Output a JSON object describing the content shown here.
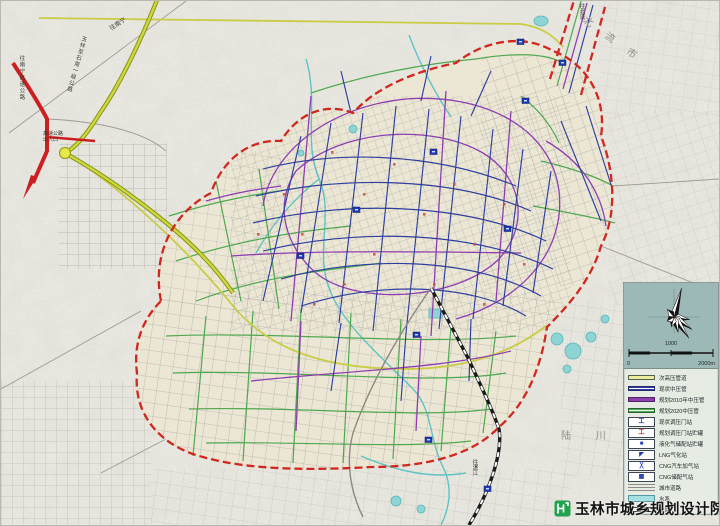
{
  "credit": {
    "institute": "玉林市城乡规划设计院"
  },
  "scale": {
    "zero": "0",
    "mid": "1000",
    "max": "2000m"
  },
  "colors": {
    "boundary_red": "#d02820",
    "pipe_existing_blue": "#2e3f9e",
    "pipe_plan2010_purple": "#8d3fb0",
    "pipe_plan2020_green": "#4fa84f",
    "pipe_subhigh_yellow": "#c9cc44",
    "highway_olive": "#c3cc36",
    "expressway_red": "#cc2020",
    "water_teal": "#5fc3c3",
    "legend_panel_teal": "#9db9b7",
    "credit_green": "#21a24e"
  },
  "legend": {
    "rows": [
      {
        "symbol": "line-yellow",
        "label": "次高压管道"
      },
      {
        "symbol": "line-blue",
        "label": "现状中压管"
      },
      {
        "symbol": "line-purple",
        "label": "规划2010年中压管"
      },
      {
        "symbol": "line-green",
        "label": "规划2020中压管"
      },
      {
        "symbol": "box-gate1",
        "label": "现状调压门站"
      },
      {
        "symbol": "box-gate2",
        "label": "规划调压门站贮罐"
      },
      {
        "symbol": "box-tank",
        "label": "液化气储配站贮罐"
      },
      {
        "symbol": "box-lng",
        "label": "LNG气化站"
      },
      {
        "symbol": "box-cng1",
        "label": "CNG汽车加气站"
      },
      {
        "symbol": "box-cng2",
        "label": "CNG储配气站"
      },
      {
        "symbol": "road",
        "label": "城市道路"
      },
      {
        "symbol": "water",
        "label": "水系"
      },
      {
        "symbol": "rail",
        "label": "铁路"
      }
    ]
  },
  "map_labels": [
    {
      "id": "beiliu",
      "text": "北 流 市"
    },
    {
      "id": "luchuan",
      "text": "陆 川 县"
    },
    {
      "id": "to_nanning",
      "text": "往南宁"
    },
    {
      "id": "hw_exit",
      "text": "高速公路\n出入口"
    },
    {
      "id": "to_beiliu",
      "text": "往北流"
    },
    {
      "id": "to_zhanjiang",
      "text": "往湛江"
    },
    {
      "id": "rd_left",
      "text": "往南宁高速公路"
    },
    {
      "id": "rd_mid",
      "text": "玉林至石南一级公路"
    }
  ]
}
